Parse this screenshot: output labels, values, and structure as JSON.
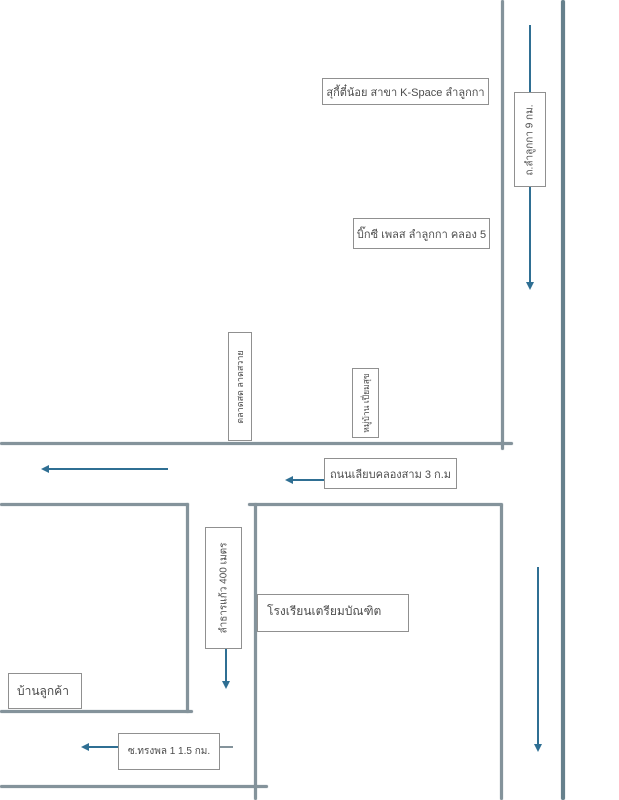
{
  "title": "hand-drawn direction map, Lam Luk Ka area",
  "colors": {
    "road": "#84939b",
    "road_dark": "#66808c",
    "arrow": "#2f6f93",
    "box_border": "#909090",
    "label_text": "#4c4c4c"
  },
  "top_area": {
    "suki_label": "สุกี้ตี๋น้อย สาขา K-Space ลำลูกกา",
    "bigc_label": "บิ๊กซี เพลส ลำลูกกา คลอง 5",
    "lamlukka_road_label": "ถ.ลำลูกกา 9 กม."
  },
  "mid_area": {
    "market_sign_label": "ตลาดสด ลาดสวาย",
    "village_sign_label": "หมู่บ้าน เปี่ยมสุข",
    "liab_khlong_sam_label": "ถนนเลียบคลองสาม 3 ก.ม"
  },
  "bottom_area": {
    "school_label": "โรงเรียนเตรียมบัณฑิต",
    "soi_distance_label": "ลำธารแก้ว 400 เมตร",
    "customer_house_label": "บ้านลูกค้า",
    "songphon_label": "ซ.ทรงพล 1 1.5 กม."
  }
}
